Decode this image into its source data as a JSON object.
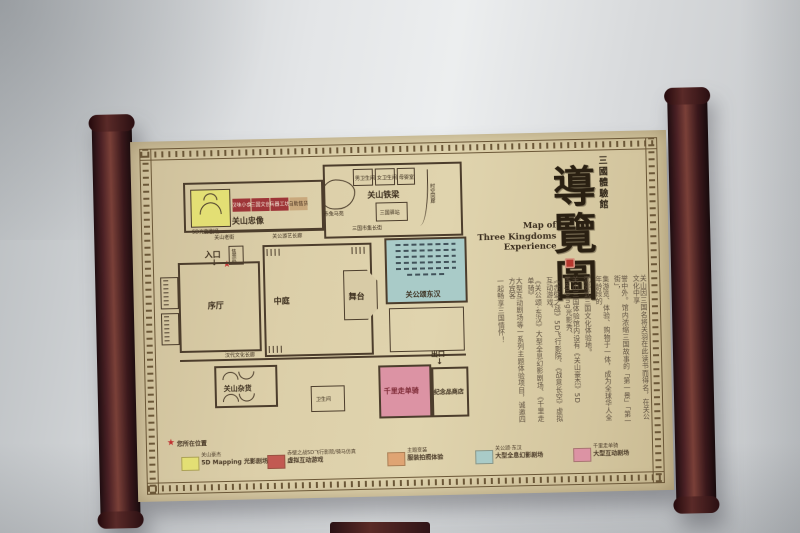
{
  "colors": {
    "wall": "#dcdee0",
    "paper": "#d8cba6",
    "rod_wood": "#4a2024",
    "plan_ink": "#4c3d2c",
    "accent_red": "#c03030",
    "legend_yellow": "#e3df74",
    "legend_red": "#c25a52",
    "legend_orange": "#dfa473",
    "legend_blue": "#a9cbc8",
    "legend_pink": "#dc93a4"
  },
  "titles": {
    "hall_vertical": "三國體驗館",
    "calligraphy": "導覽圖",
    "english_l1": "Map of",
    "english_l2": "Three Kingdoms",
    "english_l3": "Experience"
  },
  "intro": {
    "columns": [
      "关山因三国名将关羽在此读书而得名，在关公文化中享",
      "誉中外。馆内浓缩三国故事的「第一景」「第一街」，",
      "集游览、体验、购物于一体，成为全球华人全年龄段的",
      "沉浸式三国文化体验地。",
      "关山三国体验馆内设有《关山豪杰》5D Mapping光影秀、",
      "《赤壁之战》5D飞行影院、《战意长空》虚拟互动游戏、",
      "《关公颂·东汉》大型全息幻影剧场、《千里走单骑》",
      "大型互动剧场等一系列主题体验项目，诚邀四方宾客",
      "一起畅享三国情怀！"
    ]
  },
  "plan": {
    "entrance": "入口",
    "exit": "出口",
    "lobby": "序厅",
    "atrium": "中庭",
    "stage": "舞台",
    "theater": "关公颂东汉",
    "loyal_statue": "关山忠像",
    "iron_beam": "关山铁梁",
    "grocery": "关山杂货",
    "gift_shop": "纪念品商店",
    "ride": "千里走单骑",
    "restroom": "卫生间",
    "ticket": "售票处",
    "mapping_room": "5D光影剧场",
    "pond": "赤兔马苑",
    "station": "三国驿站",
    "shops": [
      "汉味小食",
      "三国文创",
      "兵器工坊",
      "自助售货"
    ],
    "corridor_top_left": "关山老街",
    "corridor_top_right": "关公游艺长廊",
    "market_street": "三国市集长街",
    "culture_corridor": "汉代文化长廊",
    "path_vertical": "时空回廊",
    "restrooms_top": [
      "男卫生间",
      "女卫生间",
      "母婴室"
    ]
  },
  "legend": {
    "you_are_here": "您所在位置",
    "items": [
      {
        "swatch": "#e3df74",
        "line1": "关山豪杰",
        "line2": "5D Mapping 光影剧场"
      },
      {
        "swatch": "#c25a52",
        "line1": "赤壁之战5D飞行影院/骑马仿真",
        "line2": "虚拟互动游戏"
      },
      {
        "swatch": "#dfa473",
        "line1": "主题变装",
        "line2": "服装拍照体验"
      },
      {
        "swatch": "#a9cbc8",
        "line1": "关公颂·东汉",
        "line2": "大型全息幻影剧场"
      },
      {
        "swatch": "#dc93a4",
        "line1": "千里走单骑",
        "line2": "大型互动剧场"
      }
    ]
  }
}
